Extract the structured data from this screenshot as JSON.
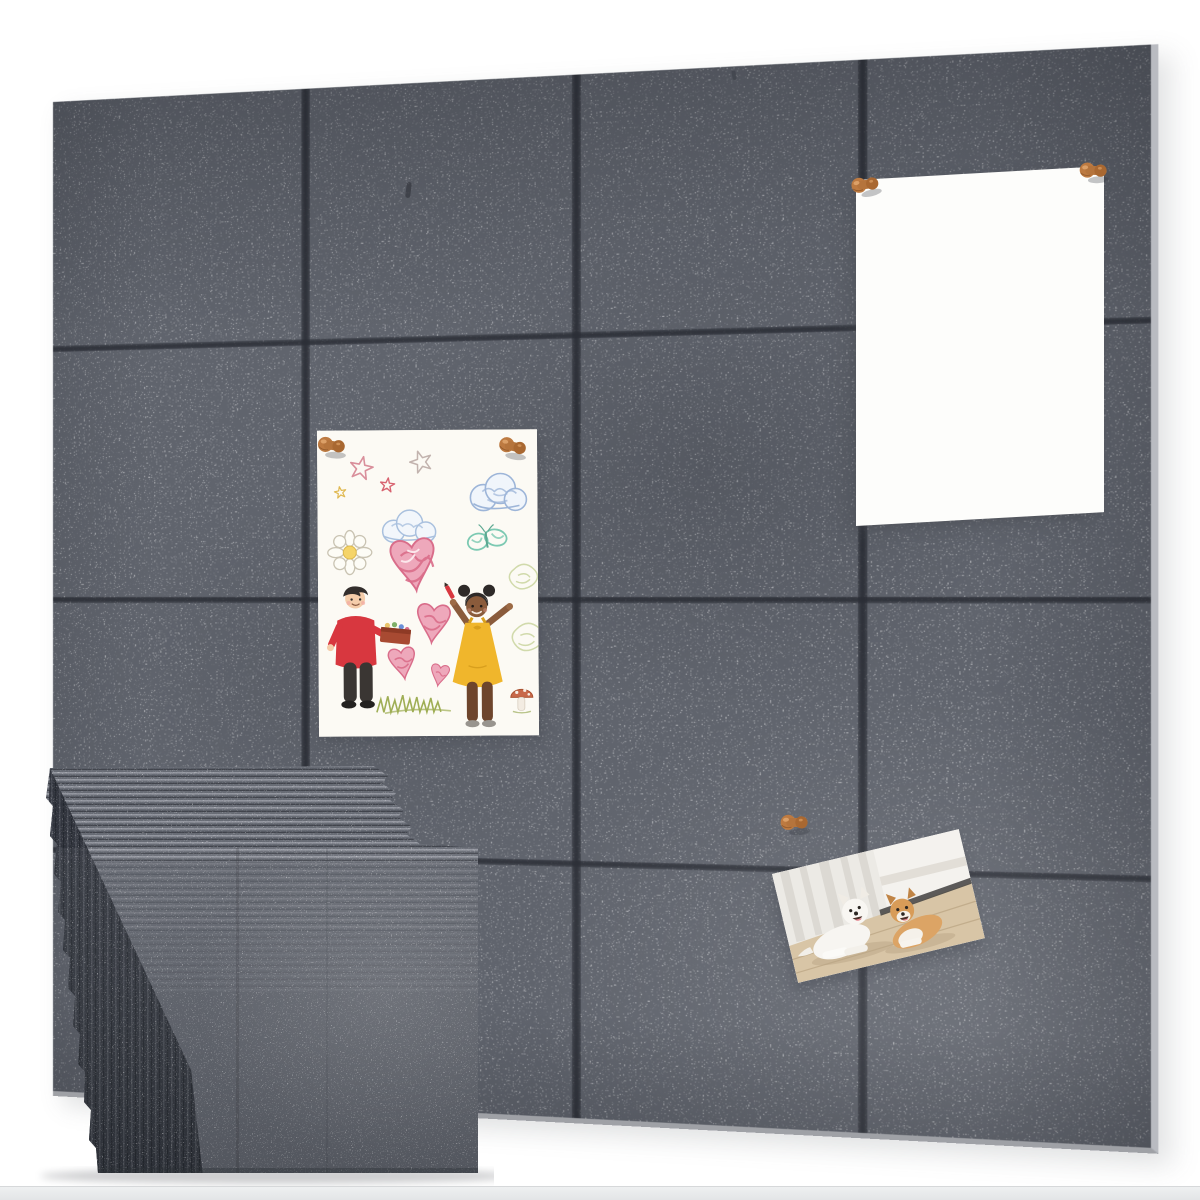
{
  "scene": {
    "type": "product-photo",
    "subject": "Gray felt acoustic wall panels arranged as a 4x4 pin board with pinned poster, kids drawing and dog photo, and a stack of felt sheets in front",
    "background_color": "#ffffff"
  },
  "wall": {
    "rows": 4,
    "columns": 4,
    "panel_count": 16,
    "panel_color": "#60646d",
    "seam_color": "#2b2e36"
  },
  "stack": {
    "label": "stack of felt panel sheets",
    "visible_sheet_edges": 12,
    "face_color": "#5c6069"
  },
  "pinned_items": [
    {
      "id": "blank-poster",
      "label": "blank white poster pinned with two wooden pins",
      "pins": 2
    },
    {
      "id": "kids-drawing",
      "label": "children's crayon drawing of a boy and girl with hearts, clouds, stars and butterfly",
      "pins": 2
    },
    {
      "id": "dogs-photo",
      "label": "photo of two dogs lying on a wooden floor",
      "pins": 1
    }
  ],
  "pins": {
    "count": 5,
    "color": "#b5743c",
    "style": "wooden knob push pin"
  },
  "palette": {
    "bg": "#ffffff",
    "felt_base": "#60646d",
    "felt_dark": "#53565f",
    "seam": "#2b2e36",
    "stack_face": "#5c6069",
    "pin_wood": "#b5743c",
    "pin_wood_dark": "#7c4a22",
    "pin_wood_light": "#dfa36b",
    "paper_white": "#fdfdfb",
    "drawing_paper": "#fcfaf4",
    "heart_pink": "#eea8bb",
    "heart_deep": "#d96d8a",
    "cloud_blue": "#9db5d8",
    "butterfly_teal": "#7cc9b2",
    "boy_red": "#d8373f",
    "girl_yellow": "#f0b62c",
    "grass_green": "#9fae55",
    "dog_tan": "#d89c58",
    "photo_floor": "#d8c5a6",
    "floor_strip": "#eef0f1"
  }
}
